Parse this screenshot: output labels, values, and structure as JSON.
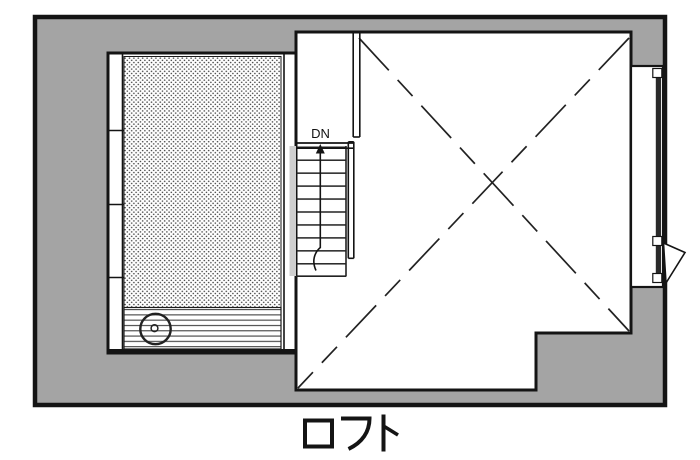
{
  "title": {
    "text": "ロフト"
  },
  "plan": {
    "stairs": {
      "direction_label": "DN"
    },
    "colors": {
      "wall_fill": "#a4a4a4",
      "line_color": "#141414",
      "paper": "#ffffff",
      "glass_line": "#2a2a2a"
    },
    "areas": [
      {
        "name": "tatami-room",
        "floor_pattern": "dot-stipple"
      },
      {
        "name": "veranda-strip",
        "floor_pattern": "horizontal-planks"
      },
      {
        "name": "staircase",
        "label": "DN",
        "treads": 10
      },
      {
        "name": "open-room",
        "marking": "dashed-x"
      }
    ]
  }
}
